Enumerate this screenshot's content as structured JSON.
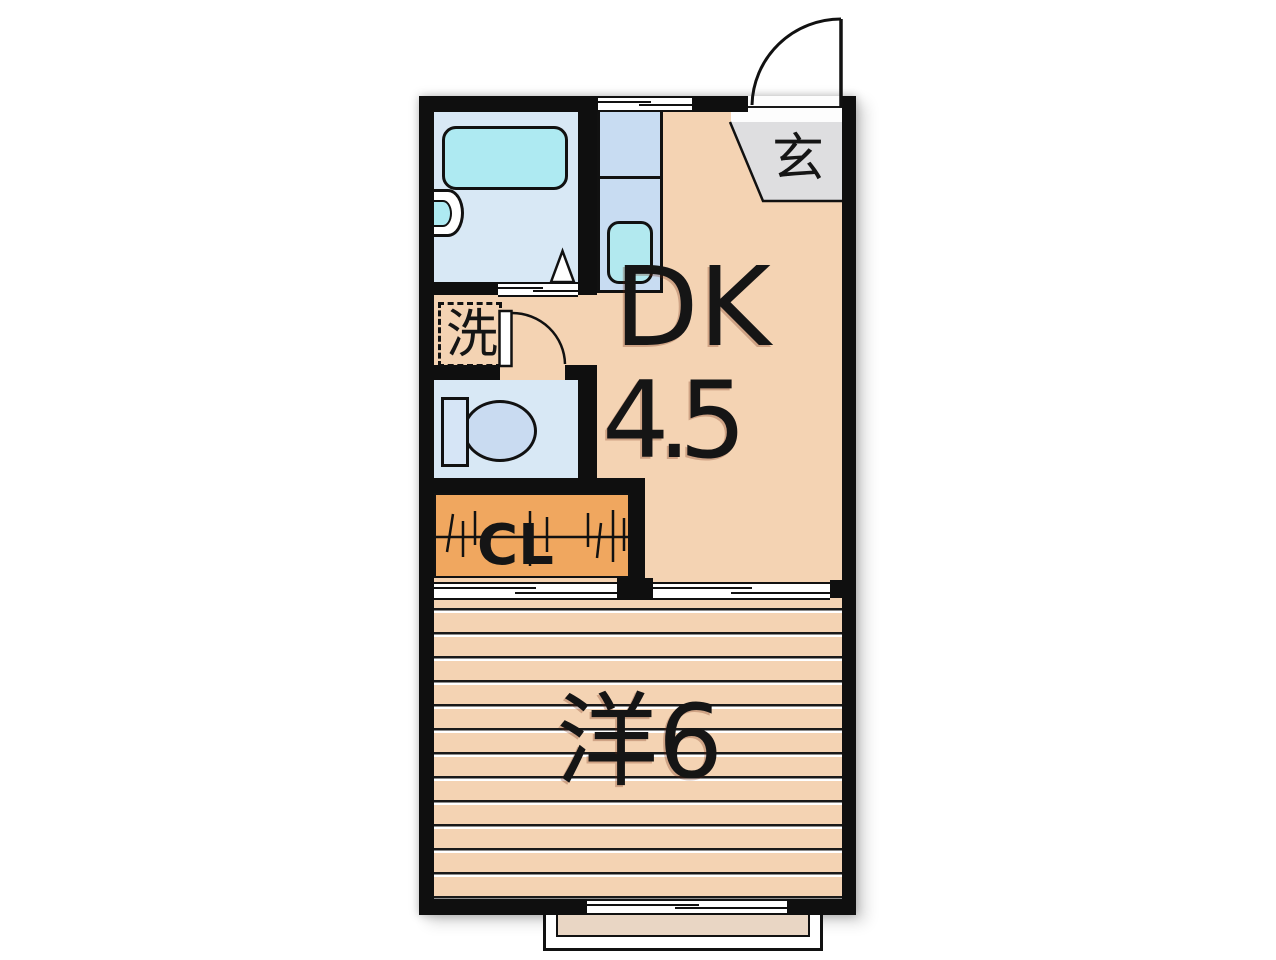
{
  "plan": {
    "type": "apartment-floor-plan",
    "labels": {
      "dining_kitchen": "DK",
      "dining_kitchen_size": "4.5",
      "western_room": "洋6",
      "entrance": "玄",
      "laundry": "洗",
      "closet": "CL"
    },
    "colors": {
      "wall": "#0f0f0f",
      "dk_floor": "#f4d3b3",
      "western_room_floor": "#f4d3b3",
      "closet_fill": "#f0a75f",
      "entrance_fill": "#dedee0",
      "bathroom_floor": "#d8e8f5",
      "bathtub_fill": "#aeeaf2",
      "kitchen_counter_fill": "#c8dcf2",
      "kitchen_sink_fill": "#b2e9ef",
      "toilet_floor": "#d8e8f5",
      "toilet_bowl_fill": "#c9dbf1",
      "balcony_fill": "#e9d6c4",
      "background": "#ffffff"
    }
  }
}
